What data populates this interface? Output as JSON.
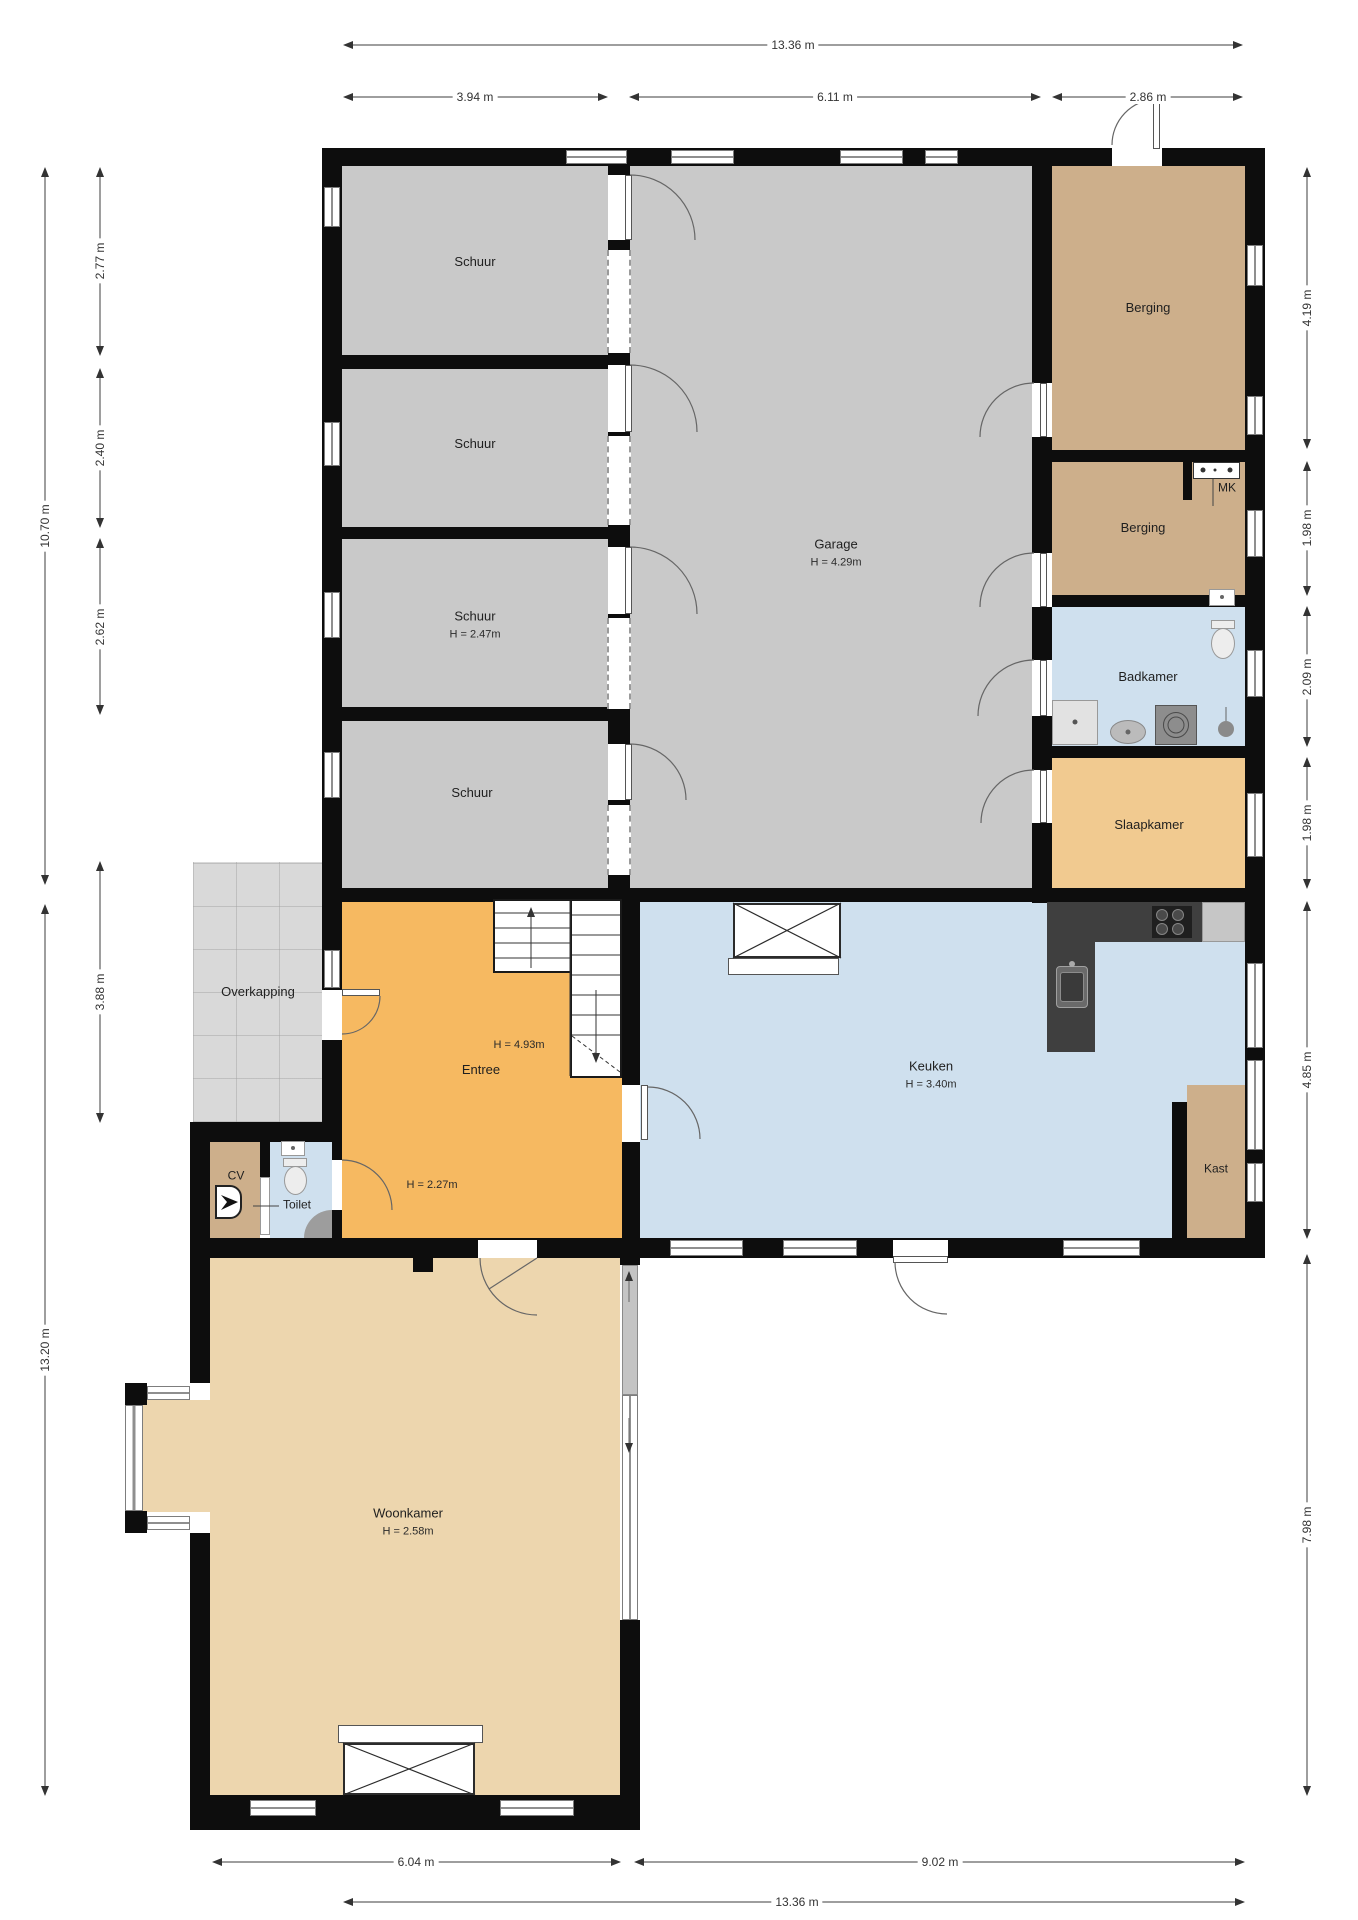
{
  "title": "Floor plan (begane grond)",
  "rooms": {
    "schuur1": {
      "label": "Schuur"
    },
    "schuur2": {
      "label": "Schuur"
    },
    "schuur3": {
      "label": "Schuur",
      "height": "H = 2.47m"
    },
    "schuur4": {
      "label": "Schuur"
    },
    "garage": {
      "label": "Garage",
      "height": "H = 4.29m"
    },
    "berging1": {
      "label": "Berging"
    },
    "berging2": {
      "label": "Berging"
    },
    "mk": {
      "label": "MK"
    },
    "badkamer": {
      "label": "Badkamer"
    },
    "slaapkamer": {
      "label": "Slaapkamer"
    },
    "keuken": {
      "label": "Keuken",
      "height": "H = 3.40m"
    },
    "kast": {
      "label": "Kast"
    },
    "entree": {
      "label": "Entree",
      "height_vide": "H = 4.93m",
      "height_low": "H = 2.27m"
    },
    "cv": {
      "label": "CV"
    },
    "toilet": {
      "label": "Toilet"
    },
    "overkapping": {
      "label": "Overkapping"
    },
    "woonkamer": {
      "label": "Woonkamer",
      "height": "H = 2.58m"
    }
  },
  "dims": {
    "top_total": "13.36 m",
    "top_a": "3.94 m",
    "top_b": "6.11 m",
    "top_c": "2.86 m",
    "left_a": "2.77 m",
    "left_b": "2.40 m",
    "left_c": "2.62 m",
    "left_total": "10.70 m",
    "left_d": "3.88 m",
    "left_total2": "13.20 m",
    "right_a": "4.19 m",
    "right_b": "1.98 m",
    "right_c": "2.09 m",
    "right_d": "1.98 m",
    "right_e": "4.85 m",
    "right_f": "7.98 m",
    "bottom_a": "6.04 m",
    "bottom_b": "9.02 m",
    "bottom_total": "13.36 m"
  },
  "colors": {
    "wall": "#0d0d0d",
    "schuur": "#c9c9c9",
    "garage": "#c9c9c9",
    "berging": "#cdaf8b",
    "badkamer": "#cfe0ee",
    "slaapkamer": "#f1ca90",
    "entree": "#f6b961",
    "keuken": "#cfe0ee",
    "woonkamer": "#edd6ae",
    "kast": "#cdaf8b",
    "cv": "#cdaf8b",
    "toilet": "#cfe0ee",
    "overkapping": "#d9d9d9"
  }
}
